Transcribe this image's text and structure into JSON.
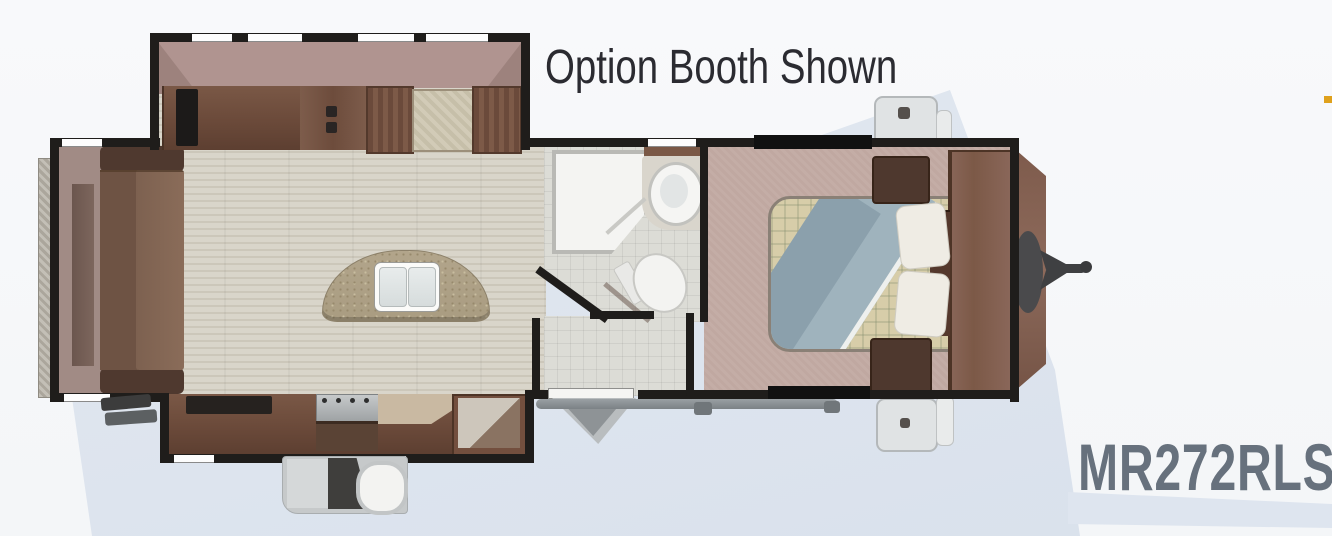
{
  "header": {
    "title": "Option Booth Shown"
  },
  "model_label": {
    "text": "MR272RLS"
  },
  "palette": {
    "background": "#f7f8fa",
    "accent_blue": "#dfe6ef",
    "wall": "#1f1d1b",
    "wood_dark": "#5f4334",
    "wood_mid": "#70503f",
    "plank_floor": "#d6d1c5",
    "carpet": "#c0a8a1",
    "tile": "#dcdcd6",
    "island_counter": "#b2a58b",
    "title_text": "#2b2b31",
    "model_text": "#67717d"
  },
  "floorplan": {
    "features": [
      "rear-bumper",
      "rear-sofa",
      "slide-out-entertainment-center",
      "tv",
      "option-booth-dinette",
      "dinette-table",
      "kitchen-island",
      "double-sink",
      "range-stove",
      "kitchen-counter",
      "refrigerator",
      "outside-kitchen",
      "entry-door-steps",
      "awning-rail",
      "rear-entry-steps",
      "shower",
      "bathroom-vanity-sink",
      "toilet",
      "queen-bed",
      "blanket",
      "pillows",
      "nightstand",
      "front-wardrobe",
      "propane-tanks",
      "hitch-tongue",
      "stabilizer-jack-pads"
    ]
  }
}
